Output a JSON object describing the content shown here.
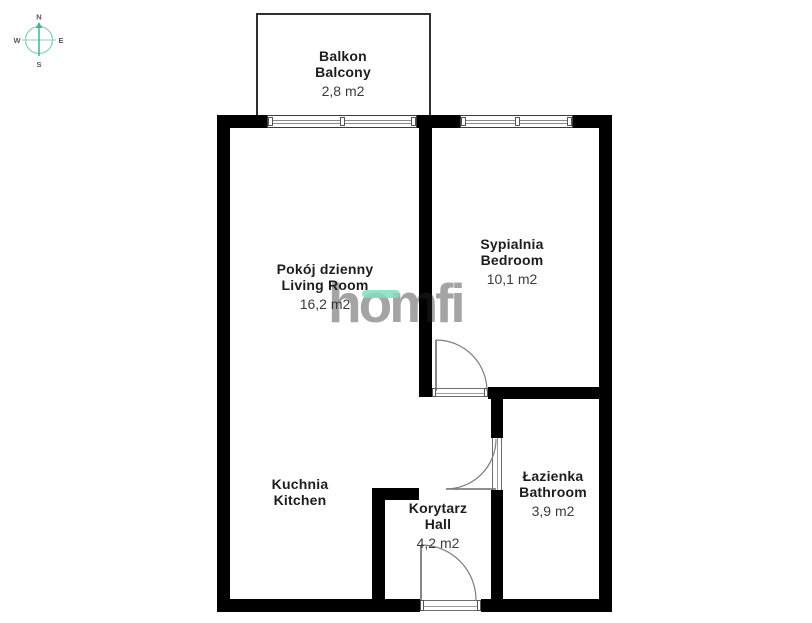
{
  "compass": {
    "north": "N",
    "east": "E",
    "south": "S",
    "west": "W"
  },
  "watermark": {
    "brand": "homfi"
  },
  "rooms": {
    "balcony": {
      "name_pl": "Balkon",
      "name_en": "Balcony",
      "area": "2,8 m2"
    },
    "living_room": {
      "name_pl": "Pokój dzienny",
      "name_en": "Living Room",
      "area": "16,2 m2"
    },
    "bedroom": {
      "name_pl": "Sypialnia",
      "name_en": "Bedroom",
      "area": "10,1 m2"
    },
    "kitchen": {
      "name_pl": "Kuchnia",
      "name_en": "Kitchen"
    },
    "hall": {
      "name_pl": "Korytarz",
      "name_en": "Hall",
      "area": "4,2 m2"
    },
    "bathroom": {
      "name_pl": "Łazienka",
      "name_en": "Bathroom",
      "area": "3,9 m2"
    }
  },
  "colors": {
    "wall": "#000000",
    "compass_teal": "#3bb593",
    "compass_teal_light": "#8fd2bc",
    "watermark_gray": "#9c9c9c",
    "watermark_accent": "#82dec0",
    "label_text": "#1d1d1d"
  }
}
